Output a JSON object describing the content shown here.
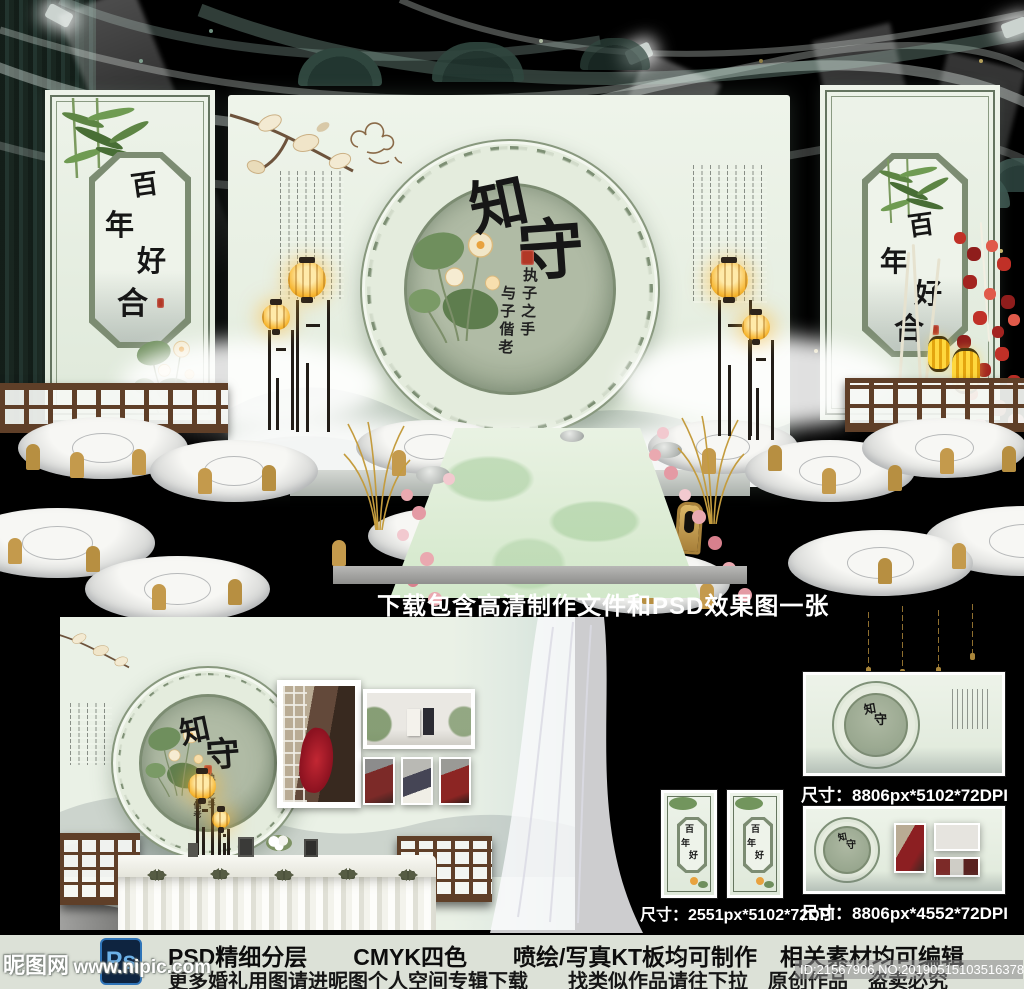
{
  "stage": {
    "caption": "下载包含高清制作文件和PSD效果图一张",
    "medallion": {
      "title_char1": "知",
      "title_char2": "守",
      "line_right": "执子之手",
      "line_left": "与子偕老"
    },
    "panel_chars": [
      "百",
      "年",
      "好",
      "合"
    ]
  },
  "thumbnails": [
    {
      "label": "尺寸：8806px*5102*72DPI"
    },
    {
      "label": "尺寸：2551px*5102*72DPI"
    },
    {
      "label": "尺寸：8806px*4552*72DPI"
    }
  ],
  "footer": {
    "ps_label": "Ps",
    "line1": "PSD精细分层　　CMYK四色　　喷绘/写真KT板均可制作　相关素材均可编辑",
    "line2": "更多婚礼用图请进昵图个人空间专辑下载　　找类似作品请往下拉　原创作品　盗卖必究",
    "watermark_site": "昵图网",
    "watermark_url": "www.nipic.com",
    "id_text": "ID:21567906 NO:20190515103516378080"
  },
  "colors": {
    "backdrop_mint": "#eaf1e5",
    "medallion_sage": "#a3af99",
    "ring_green": "#7d8f74",
    "gold_chair": "#c49a4c",
    "wood_brown": "#5f3f28",
    "seal_red": "#b23826",
    "lantern_gold": "#f7b733",
    "footer_bg": "#dce1d7"
  }
}
